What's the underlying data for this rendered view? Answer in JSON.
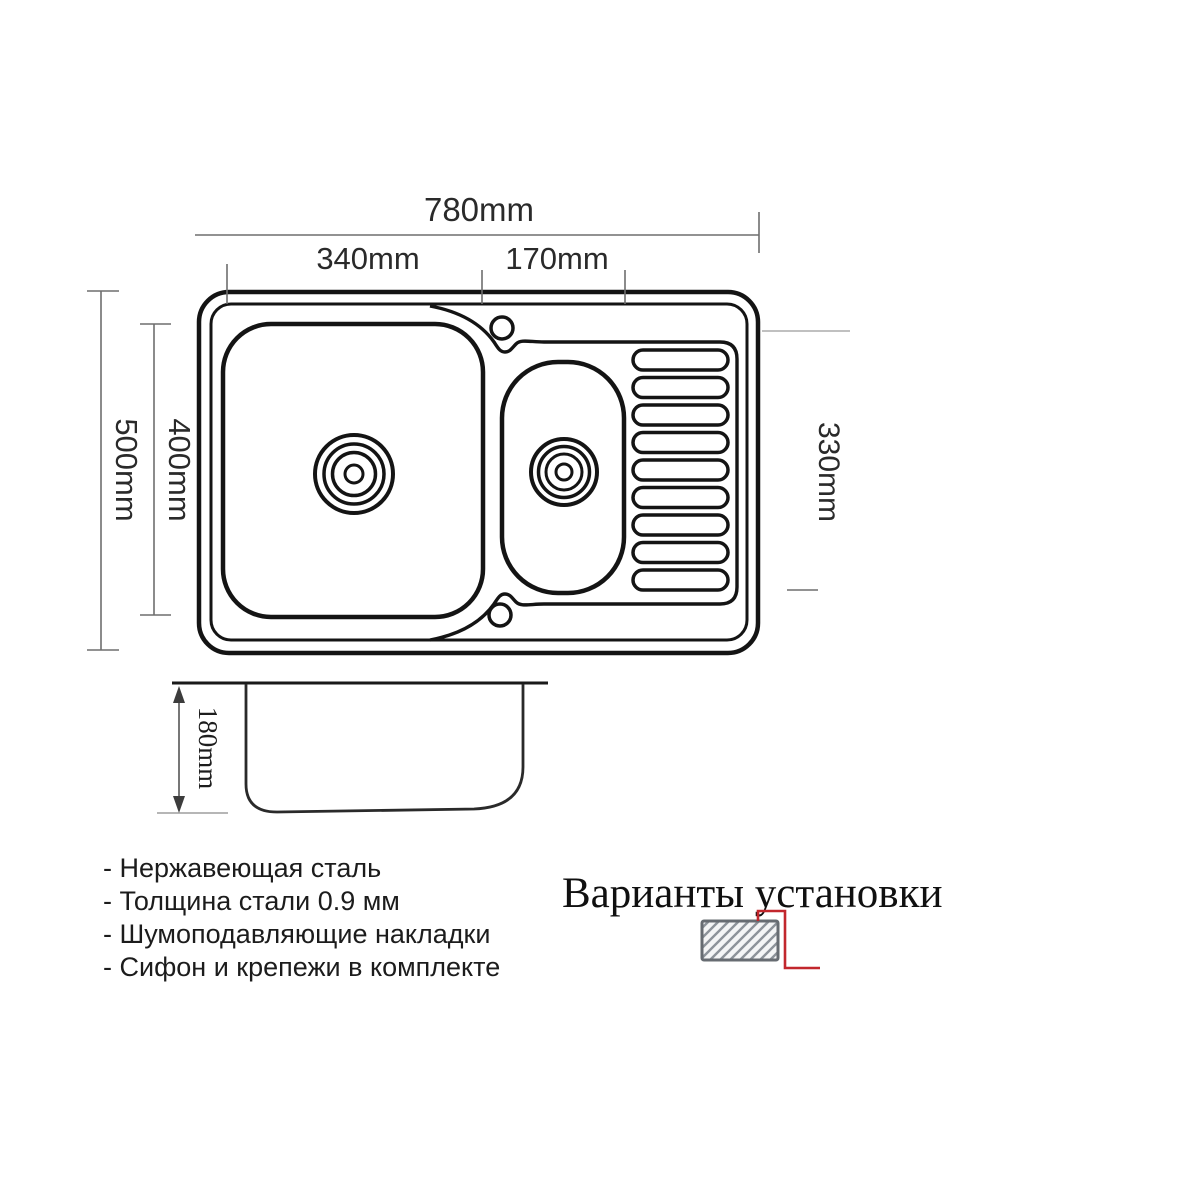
{
  "dimensions": {
    "total_width": "780mm",
    "main_bowl_width": "340mm",
    "small_bowl_width": "170mm",
    "total_depth": "500mm",
    "bowl_depth": "400mm",
    "drainboard_depth": "330mm",
    "bowl_height": "180mm"
  },
  "features": {
    "items": [
      "- Нержавеющая сталь",
      "- Толщина стали 0.9 мм",
      "- Шумоподавляющие накладки",
      "- Сифон и крепежи в комплекте"
    ]
  },
  "installation": {
    "title": "Варианты установки"
  },
  "colors": {
    "drawing_line": "#141414",
    "dimension_line": "#6e6e6e",
    "accent_red": "#c2272d",
    "hatch_border": "#676c72",
    "hatch_line": "#8d939a"
  }
}
